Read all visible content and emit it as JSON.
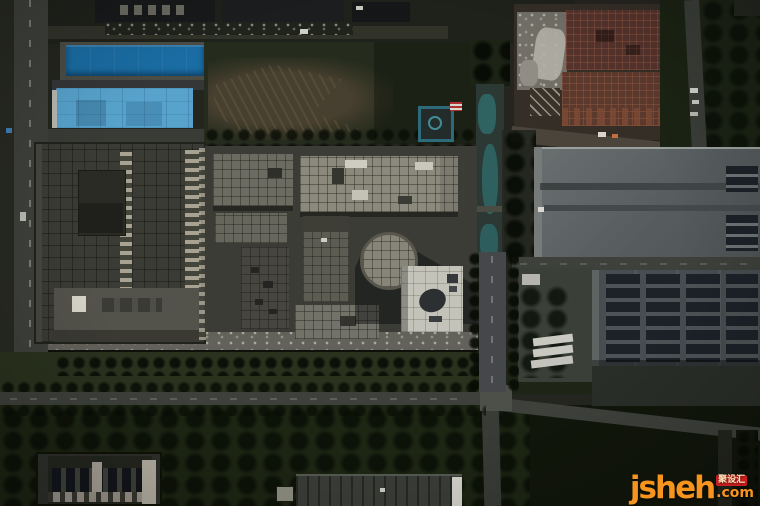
{
  "scene": {
    "type": "aerial-photograph",
    "regions": [
      "left-vertical-road",
      "dark-blue-pool-roof",
      "light-blue-panel-roof",
      "left-factory-block",
      "center-factory-complex",
      "circular-glass-roof",
      "white-roof-building",
      "green-field-with-dirt",
      "teal-canal-strip",
      "construction-site-rebar",
      "gray-warehouse-north",
      "solar-panel-warehouse",
      "green-buffer-strips",
      "south-road-intersection",
      "bottom-left-tower",
      "bottom-center-sheds",
      "watermark-logo"
    ]
  },
  "watermark": {
    "brand": "jsheh",
    "badge": "聚设汇",
    "tld": ".com"
  },
  "palette": {
    "ground": "#23251e",
    "groundDark": "#1f211b",
    "road": "#3e403b",
    "roadDark": "#313329",
    "roadLight": "#4d4f49",
    "vegBand": "#2a321e",
    "vegDark": "#1d2513",
    "fieldGreen": "#262c1d",
    "fieldBrown": "#473f2f",
    "poolDark": "#1a6da4",
    "poolLight": "#57a3cd",
    "roofLight": "#8b887c",
    "roofMid": "#6c6b61",
    "roofDim": "#5c5c53",
    "roofDark": "#46453e",
    "roofWhite": "#c4c3b9",
    "factoryRoof": "#3a3b34",
    "whGray": "#5e6466",
    "whDark": "#474d50",
    "solar": "#1c2228",
    "rebar": "#54332c",
    "concrete": "#716f66",
    "canal": "#2b3833",
    "teal": "#2f6e6e",
    "wmOrange": "#f7941d",
    "wmRed": "#ce1f1f",
    "wmBadgeText": "#ffe3b8"
  }
}
